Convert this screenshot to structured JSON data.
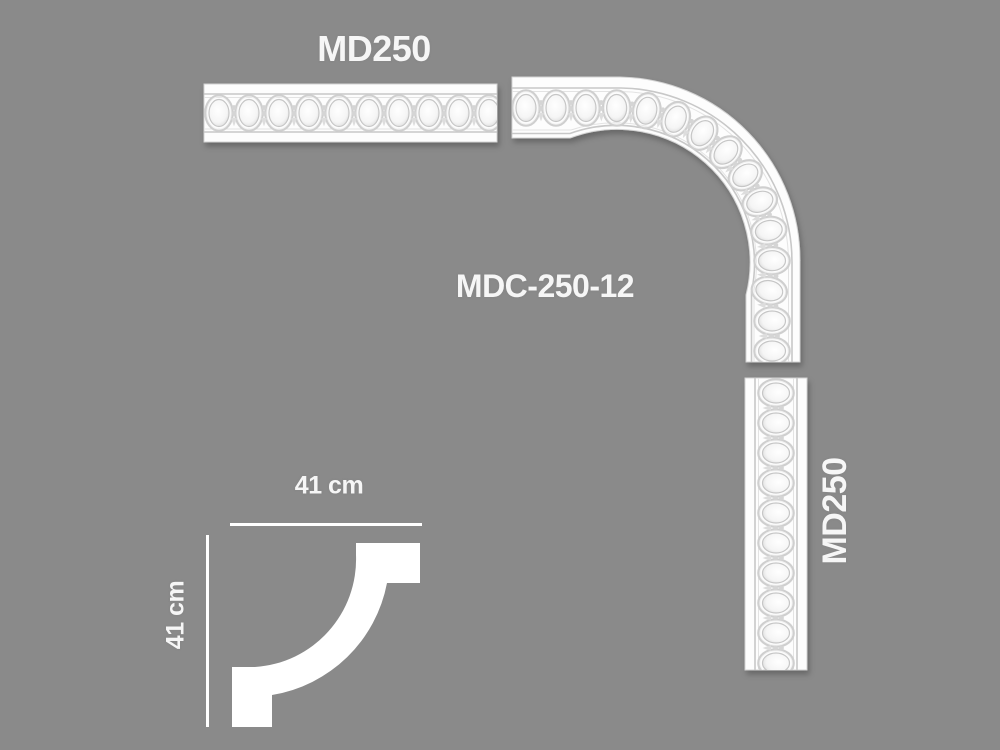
{
  "colors": {
    "background": "#8a8a8a",
    "piece_white": "#fdfdfd",
    "label_text": "#f6f6f6"
  },
  "pieces": {
    "top_strip": {
      "label": "MD250"
    },
    "corner": {
      "label": "MDC-250-12"
    },
    "right_strip": {
      "label": "MD250"
    }
  },
  "dimensions": {
    "width_label": "41 cm",
    "height_label": "41 cm"
  }
}
